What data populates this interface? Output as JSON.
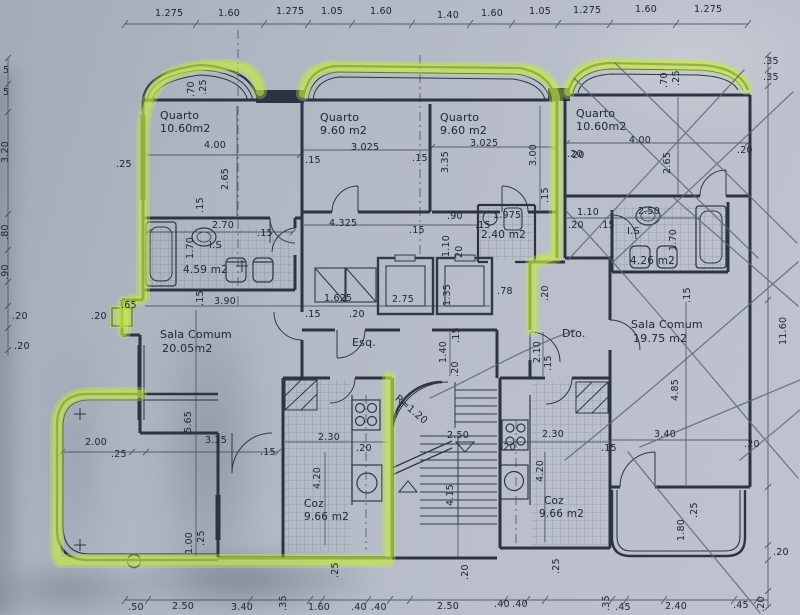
{
  "document": {
    "kind": "apartment floor plan (scanned)",
    "units": {
      "left": "Esq.",
      "right": "Dto."
    },
    "highlight_color": "#c8f03e",
    "ink_color": "#2b3140",
    "paper_color": "#b2b7c4"
  },
  "rooms": [
    {
      "id": "quarto-1",
      "label": "Quarto",
      "area": "10.60m2",
      "unit": "Esq."
    },
    {
      "id": "quarto-2",
      "label": "Quarto",
      "area": "9.60 m2",
      "unit": "Esq."
    },
    {
      "id": "quarto-3",
      "label": "Quarto",
      "area": "9.60 m2",
      "unit": "Esq."
    },
    {
      "id": "quarto-4",
      "label": "Quarto",
      "area": "10.60m2",
      "unit": "Dto."
    },
    {
      "id": "sala-esq",
      "label": "Sala Comum",
      "area": "20.05m2",
      "unit": "Esq."
    },
    {
      "id": "sala-dto",
      "label": "Sala Comum",
      "area": "19.75 m2",
      "unit": "Dto."
    },
    {
      "id": "coz-esq",
      "label": "Coz",
      "area": "9.66 m2",
      "unit": "Esq."
    },
    {
      "id": "coz-dto",
      "label": "Coz",
      "area": "9.66 m2",
      "unit": "Dto."
    },
    {
      "id": "is-esq",
      "label": "I.S",
      "area": "4.59 m2",
      "unit": "Esq."
    },
    {
      "id": "is-dto",
      "label": "I.S",
      "area": "4.26 m2",
      "unit": "Dto."
    },
    {
      "id": "wc",
      "label": "",
      "area": "2.40 m2",
      "unit": "Esq."
    }
  ],
  "stair_note": "R=1.20",
  "labels": [
    {
      "t": "1.275",
      "x": 155,
      "y": 9
    },
    {
      "t": "1.60",
      "x": 218,
      "y": 9
    },
    {
      "t": "1.275",
      "x": 276,
      "y": 7
    },
    {
      "t": "1.05",
      "x": 321,
      "y": 7
    },
    {
      "t": "1.60",
      "x": 370,
      "y": 7
    },
    {
      "t": "1.40",
      "x": 437,
      "y": 11
    },
    {
      "t": "1.60",
      "x": 481,
      "y": 9
    },
    {
      "t": "1.05",
      "x": 529,
      "y": 7
    },
    {
      "t": "1.275",
      "x": 573,
      "y": 6
    },
    {
      "t": "1.60",
      "x": 635,
      "y": 5
    },
    {
      "t": "1.275",
      "x": 694,
      "y": 5
    },
    {
      "t": ".35",
      "x": 763,
      "y": 57
    },
    {
      "t": ".35",
      "x": 763,
      "y": 73
    },
    {
      "t": "11.60",
      "x": 779,
      "y": 345,
      "r": -90
    },
    {
      "t": ".20",
      "x": 773,
      "y": 548
    },
    {
      "t": ".20",
      "x": 757,
      "y": 612,
      "r": -90
    },
    {
      "t": "5",
      "x": 3,
      "y": 66
    },
    {
      "t": "5",
      "x": 3,
      "y": 88
    },
    {
      "t": "3.20",
      "x": 1,
      "y": 163,
      "r": -90
    },
    {
      "t": ".80",
      "x": 1,
      "y": 240,
      "r": -90
    },
    {
      "t": ".90",
      "x": 1,
      "y": 280,
      "r": -90
    },
    {
      "t": ".20",
      "x": 12,
      "y": 312
    },
    {
      "t": ".20",
      "x": 14,
      "y": 342
    },
    {
      "t": ".25",
      "x": 116,
      "y": 160
    },
    {
      "t": ".65",
      "x": 121,
      "y": 301
    },
    {
      "t": ".20",
      "x": 91,
      "y": 312
    },
    {
      "t": ".70",
      "x": 187,
      "y": 97,
      "r": -90
    },
    {
      "t": ".25",
      "x": 199,
      "y": 95,
      "r": -90
    },
    {
      "t": ".70",
      "x": 660,
      "y": 88,
      "r": -90
    },
    {
      "t": ".25",
      "x": 672,
      "y": 86,
      "r": -90
    },
    {
      "t": "Quarto",
      "x": 160,
      "y": 110,
      "s": 11,
      "n": "room-label-quarto-1"
    },
    {
      "t": "10.60m2",
      "x": 160,
      "y": 123,
      "s": 11
    },
    {
      "t": "4.00",
      "x": 204,
      "y": 141
    },
    {
      "t": "2.65",
      "x": 221,
      "y": 190,
      "r": -90
    },
    {
      "t": ".15",
      "x": 196,
      "y": 213,
      "r": -90
    },
    {
      "t": "Quarto",
      "x": 320,
      "y": 112,
      "s": 11,
      "n": "room-label-quarto-2"
    },
    {
      "t": "9.60 m2",
      "x": 320,
      "y": 125,
      "s": 11
    },
    {
      "t": ".15",
      "x": 305,
      "y": 156
    },
    {
      "t": "3.025",
      "x": 351,
      "y": 143
    },
    {
      "t": "Quarto",
      "x": 440,
      "y": 112,
      "s": 11,
      "n": "room-label-quarto-3"
    },
    {
      "t": "9.60 m2",
      "x": 440,
      "y": 125,
      "s": 11
    },
    {
      "t": "3.35",
      "x": 441,
      "y": 173,
      "r": -90
    },
    {
      "t": "3.025",
      "x": 470,
      "y": 139
    },
    {
      "t": "3.00",
      "x": 529,
      "y": 166,
      "r": -90
    },
    {
      "t": ".15",
      "x": 412,
      "y": 154
    },
    {
      "t": "20",
      "x": 572,
      "y": 151
    },
    {
      "t": "Quarto",
      "x": 576,
      "y": 108,
      "s": 11,
      "n": "room-label-quarto-4"
    },
    {
      "t": "10.60m2",
      "x": 576,
      "y": 121,
      "s": 11
    },
    {
      "t": "4.00",
      "x": 629,
      "y": 136
    },
    {
      "t": "2.65",
      "x": 663,
      "y": 174,
      "r": -90
    },
    {
      "t": ".20",
      "x": 737,
      "y": 146
    },
    {
      "t": ".20",
      "x": 567,
      "y": 150
    },
    {
      "t": "2.70",
      "x": 212,
      "y": 221
    },
    {
      "t": ".15",
      "x": 257,
      "y": 229
    },
    {
      "t": "1.70",
      "x": 186,
      "y": 259,
      "r": -90
    },
    {
      "t": "I.S",
      "x": 209,
      "y": 241,
      "s": 10
    },
    {
      "t": "4.59 m2",
      "x": 183,
      "y": 265,
      "s": 10.5,
      "n": "area-label-is-esq"
    },
    {
      "t": ".15",
      "x": 196,
      "y": 306,
      "r": -90
    },
    {
      "t": "3.90",
      "x": 214,
      "y": 297
    },
    {
      "t": "4.325",
      "x": 329,
      "y": 219
    },
    {
      "t": ".15",
      "x": 409,
      "y": 226
    },
    {
      "t": ".90",
      "x": 447,
      "y": 212
    },
    {
      "t": "1.10",
      "x": 442,
      "y": 257,
      "r": -90
    },
    {
      "t": "20",
      "x": 455,
      "y": 258,
      "r": -90
    },
    {
      "t": ".15",
      "x": 475,
      "y": 221
    },
    {
      "t": "1.975",
      "x": 493,
      "y": 211
    },
    {
      "t": "2.40 m2",
      "x": 481,
      "y": 230,
      "s": 10.5,
      "n": "area-label-wc"
    },
    {
      "t": ".15",
      "x": 541,
      "y": 203,
      "r": -90
    },
    {
      "t": "1.625",
      "x": 324,
      "y": 294
    },
    {
      "t": ".15",
      "x": 305,
      "y": 310
    },
    {
      "t": ".20",
      "x": 349,
      "y": 310
    },
    {
      "t": "2.75",
      "x": 392,
      "y": 295
    },
    {
      "t": "1.35",
      "x": 443,
      "y": 306,
      "r": -90
    },
    {
      "t": ".78",
      "x": 497,
      "y": 287
    },
    {
      "t": ".20",
      "x": 541,
      "y": 301,
      "r": -90
    },
    {
      "t": "Esq.",
      "x": 352,
      "y": 337,
      "s": 11,
      "n": "unit-label-esq"
    },
    {
      "t": "Dto.",
      "x": 562,
      "y": 328,
      "s": 11,
      "n": "unit-label-dto"
    },
    {
      "t": "1.40",
      "x": 439,
      "y": 363,
      "r": -90
    },
    {
      "t": ".15",
      "x": 452,
      "y": 343,
      "r": -90
    },
    {
      "t": ".20",
      "x": 451,
      "y": 377,
      "r": -90
    },
    {
      "t": "2.10",
      "x": 533,
      "y": 363,
      "r": -90
    },
    {
      "t": ".15",
      "x": 544,
      "y": 371,
      "r": -90
    },
    {
      "t": "Sala Comum",
      "x": 160,
      "y": 329,
      "s": 11,
      "n": "room-label-sala-esq"
    },
    {
      "t": "20.05m2",
      "x": 162,
      "y": 343,
      "s": 11
    },
    {
      "t": "5.65",
      "x": 184,
      "y": 433,
      "r": -90
    },
    {
      "t": "2.00",
      "x": 85,
      "y": 438
    },
    {
      "t": ".25",
      "x": 111,
      "y": 450
    },
    {
      "t": "3.35",
      "x": 205,
      "y": 436
    },
    {
      "t": ".15",
      "x": 260,
      "y": 448
    },
    {
      "t": "1.00",
      "x": 185,
      "y": 554,
      "r": -90
    },
    {
      "t": ".25",
      "x": 197,
      "y": 546,
      "r": -90
    },
    {
      "t": "2.30",
      "x": 318,
      "y": 433
    },
    {
      "t": "4.20",
      "x": 313,
      "y": 489,
      "r": -90
    },
    {
      "t": ".20",
      "x": 356,
      "y": 444
    },
    {
      "t": "Coz",
      "x": 304,
      "y": 499,
      "s": 10.5,
      "n": "room-label-coz-esq"
    },
    {
      "t": "9.66 m2",
      "x": 304,
      "y": 512,
      "s": 10.5
    },
    {
      "t": ".25",
      "x": 331,
      "y": 578,
      "r": -90
    },
    {
      "t": "R=1.20",
      "x": 399,
      "y": 394,
      "r": 40,
      "s": 10,
      "n": "stair-radius-note"
    },
    {
      "t": "2.50",
      "x": 447,
      "y": 431
    },
    {
      "t": "4.15",
      "x": 446,
      "y": 506,
      "r": -90
    },
    {
      "t": ".20",
      "x": 461,
      "y": 580,
      "r": -90
    },
    {
      "t": ".20",
      "x": 500,
      "y": 443
    },
    {
      "t": "2.30",
      "x": 542,
      "y": 430
    },
    {
      "t": "4.20",
      "x": 536,
      "y": 482,
      "r": -90
    },
    {
      "t": "Coz",
      "x": 544,
      "y": 496,
      "s": 10.5,
      "n": "room-label-coz-dto"
    },
    {
      "t": "9.66 m2",
      "x": 539,
      "y": 509,
      "s": 10.5
    },
    {
      "t": ".25",
      "x": 552,
      "y": 574,
      "r": -90
    },
    {
      "t": ".15",
      "x": 601,
      "y": 444
    },
    {
      "t": "Sala Comum",
      "x": 631,
      "y": 319,
      "s": 11,
      "n": "room-label-sala-dto"
    },
    {
      "t": "19.75 m2",
      "x": 633,
      "y": 333,
      "s": 11
    },
    {
      "t": "4.85",
      "x": 671,
      "y": 401,
      "r": -90
    },
    {
      "t": "3.40",
      "x": 654,
      "y": 430
    },
    {
      "t": ".20",
      "x": 744,
      "y": 440
    },
    {
      "t": "1.80",
      "x": 677,
      "y": 541,
      "r": -90
    },
    {
      "t": ".25",
      "x": 690,
      "y": 518,
      "r": -90
    },
    {
      "t": "1.10",
      "x": 577,
      "y": 208
    },
    {
      "t": ".20",
      "x": 568,
      "y": 221
    },
    {
      "t": ".15",
      "x": 599,
      "y": 221
    },
    {
      "t": "2.50",
      "x": 638,
      "y": 207
    },
    {
      "t": "1.70",
      "x": 669,
      "y": 251,
      "r": -90
    },
    {
      "t": "I.S",
      "x": 627,
      "y": 227,
      "s": 10
    },
    {
      "t": "4.26 m2",
      "x": 630,
      "y": 256,
      "s": 10.5,
      "n": "area-label-is-dto"
    },
    {
      "t": ".15",
      "x": 683,
      "y": 303,
      "r": -90
    },
    {
      "t": ".50",
      "x": 128,
      "y": 603
    },
    {
      "t": "2.50",
      "x": 172,
      "y": 602
    },
    {
      "t": "3.40",
      "x": 231,
      "y": 603
    },
    {
      "t": ".35",
      "x": 279,
      "y": 611,
      "r": -90
    },
    {
      "t": "1.60",
      "x": 308,
      "y": 603
    },
    {
      "t": ".40",
      "x": 351,
      "y": 603
    },
    {
      "t": ".40",
      "x": 371,
      "y": 603
    },
    {
      "t": "2.50",
      "x": 437,
      "y": 602
    },
    {
      "t": ".40",
      "x": 494,
      "y": 600
    },
    {
      "t": ".40",
      "x": 512,
      "y": 600
    },
    {
      "t": ".35",
      "x": 602,
      "y": 611,
      "r": -90
    },
    {
      "t": ".45",
      "x": 615,
      "y": 603
    },
    {
      "t": "2.40",
      "x": 665,
      "y": 602
    },
    {
      "t": ".45",
      "x": 733,
      "y": 601
    }
  ]
}
